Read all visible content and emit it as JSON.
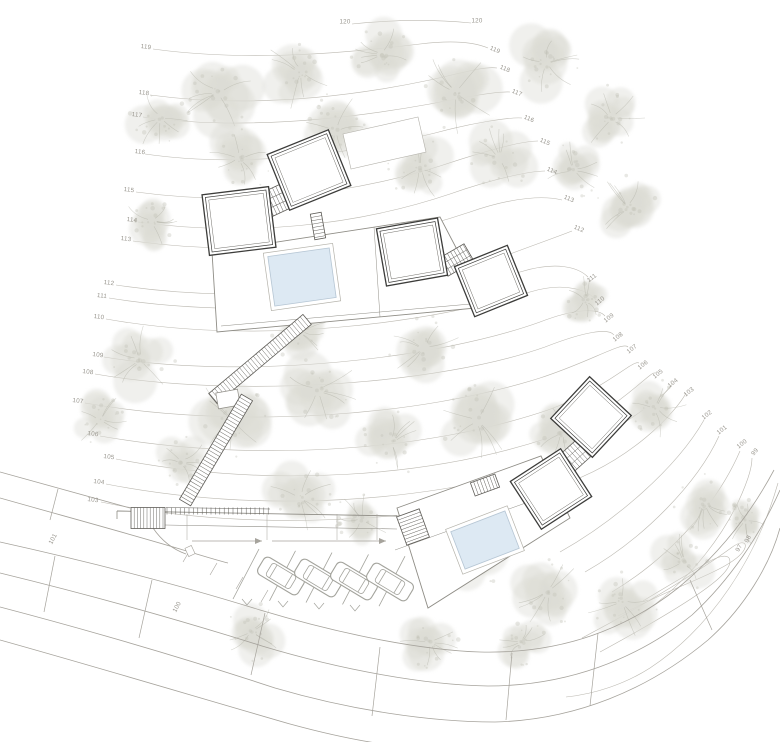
{
  "drawing": {
    "type": "architectural site plan",
    "cabins": 6,
    "pools": 2,
    "cars": 4
  },
  "colors": {
    "background": "#ffffff",
    "contour": "#b7b4ac",
    "contour_label": "#97948c",
    "tree_fill": "#dcdcd4",
    "tree_speckle": "#c3c3b9",
    "tree_branch": "#aeaea4",
    "building_line": "#3c3c3a",
    "building_inner": "#6a6862",
    "platform_line": "#8f8d86",
    "pool_fill": "#dde9f3",
    "pool_edge": "#b6c6d4",
    "road_line": "#a6a39c",
    "car_line": "#a3a39c",
    "stair_line": "#5f5d58"
  },
  "contour_labels": [
    {
      "v": "120",
      "x": 345,
      "y": 22,
      "r": 0
    },
    {
      "v": "120",
      "x": 477,
      "y": 21,
      "r": 0
    },
    {
      "v": "119",
      "x": 146,
      "y": 47,
      "r": 7
    },
    {
      "v": "118",
      "x": 144,
      "y": 93,
      "r": 7
    },
    {
      "v": "117",
      "x": 137,
      "y": 115,
      "r": 7
    },
    {
      "v": "116",
      "x": 140,
      "y": 152,
      "r": 7
    },
    {
      "v": "115",
      "x": 129,
      "y": 190,
      "r": 7
    },
    {
      "v": "114",
      "x": 132,
      "y": 220,
      "r": 7
    },
    {
      "v": "113",
      "x": 126,
      "y": 239,
      "r": 7
    },
    {
      "v": "112",
      "x": 109,
      "y": 283,
      "r": 7
    },
    {
      "v": "111",
      "x": 102,
      "y": 296,
      "r": 7
    },
    {
      "v": "110",
      "x": 99,
      "y": 317,
      "r": 7
    },
    {
      "v": "109",
      "x": 98,
      "y": 355,
      "r": 7
    },
    {
      "v": "108",
      "x": 88,
      "y": 372,
      "r": 7
    },
    {
      "v": "107",
      "x": 78,
      "y": 401,
      "r": 7
    },
    {
      "v": "106",
      "x": 93,
      "y": 434,
      "r": 7
    },
    {
      "v": "105",
      "x": 109,
      "y": 457,
      "r": 7
    },
    {
      "v": "104",
      "x": 99,
      "y": 482,
      "r": 7
    },
    {
      "v": "103",
      "x": 93,
      "y": 500,
      "r": 7
    },
    {
      "v": "119",
      "x": 495,
      "y": 50,
      "r": 22
    },
    {
      "v": "118",
      "x": 505,
      "y": 69,
      "r": 22
    },
    {
      "v": "117",
      "x": 517,
      "y": 93,
      "r": 22
    },
    {
      "v": "116",
      "x": 529,
      "y": 119,
      "r": 22
    },
    {
      "v": "115",
      "x": 545,
      "y": 142,
      "r": 22
    },
    {
      "v": "114",
      "x": 552,
      "y": 171,
      "r": 22
    },
    {
      "v": "113",
      "x": 569,
      "y": 199,
      "r": 22
    },
    {
      "v": "112",
      "x": 579,
      "y": 229,
      "r": 22
    },
    {
      "v": "111",
      "x": 592,
      "y": 278,
      "r": -38
    },
    {
      "v": "110",
      "x": 600,
      "y": 301,
      "r": -38
    },
    {
      "v": "109",
      "x": 609,
      "y": 318,
      "r": -38
    },
    {
      "v": "108",
      "x": 618,
      "y": 337,
      "r": -38
    },
    {
      "v": "107",
      "x": 632,
      "y": 349,
      "r": -38
    },
    {
      "v": "106",
      "x": 643,
      "y": 365,
      "r": -38
    },
    {
      "v": "105",
      "x": 658,
      "y": 374,
      "r": -38
    },
    {
      "v": "104",
      "x": 673,
      "y": 383,
      "r": -38
    },
    {
      "v": "103",
      "x": 689,
      "y": 392,
      "r": -38
    },
    {
      "v": "102",
      "x": 707,
      "y": 415,
      "r": -38
    },
    {
      "v": "101",
      "x": 722,
      "y": 430,
      "r": -38
    },
    {
      "v": "100",
      "x": 742,
      "y": 444,
      "r": -38
    },
    {
      "v": "99",
      "x": 755,
      "y": 452,
      "r": -50
    },
    {
      "v": "98",
      "x": 748,
      "y": 539,
      "r": -62
    },
    {
      "v": "97",
      "x": 739,
      "y": 548,
      "r": -62
    }
  ],
  "road_labels": [
    {
      "v": "101",
      "x": 53,
      "y": 539,
      "r": -62
    },
    {
      "v": "100",
      "x": 177,
      "y": 607,
      "r": -62
    }
  ]
}
